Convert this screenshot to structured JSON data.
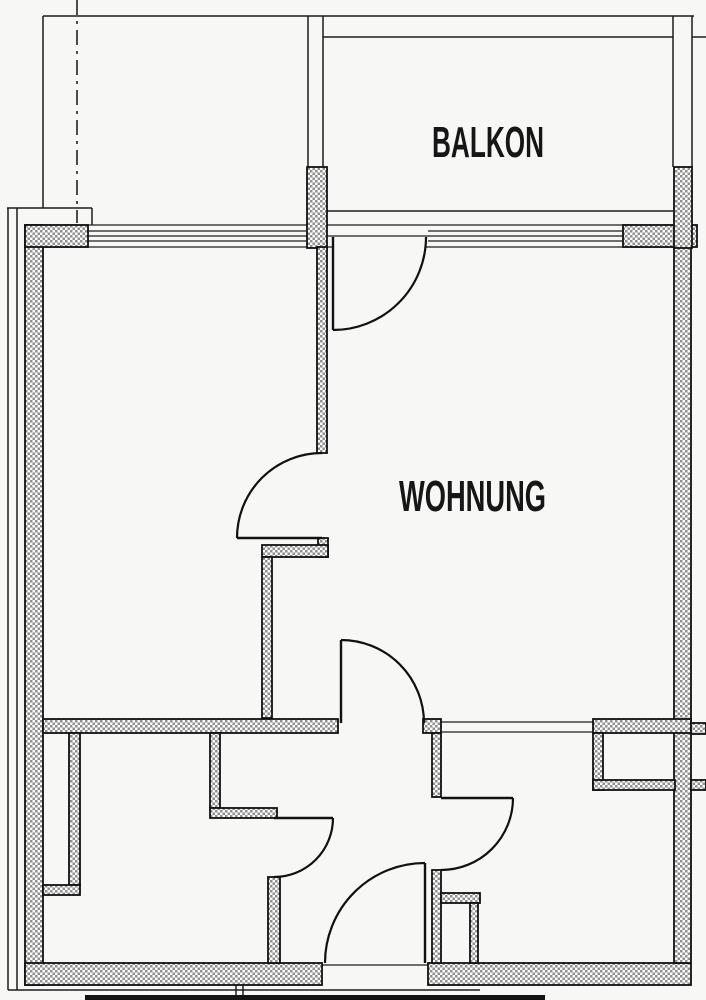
{
  "plan": {
    "type": "apartment-floor-plan",
    "labels": {
      "balkon": "BALKON",
      "wohnung": "WOHNUNG"
    },
    "rooms": [
      {
        "name": "balcony",
        "label": "BALKON"
      },
      {
        "name": "apartment-living-area",
        "label": "WOHNUNG"
      }
    ],
    "colors": {
      "line": "#1d1d1d",
      "wall_hatch": "#8f8f8f",
      "paper": "#f7f7f5"
    }
  }
}
